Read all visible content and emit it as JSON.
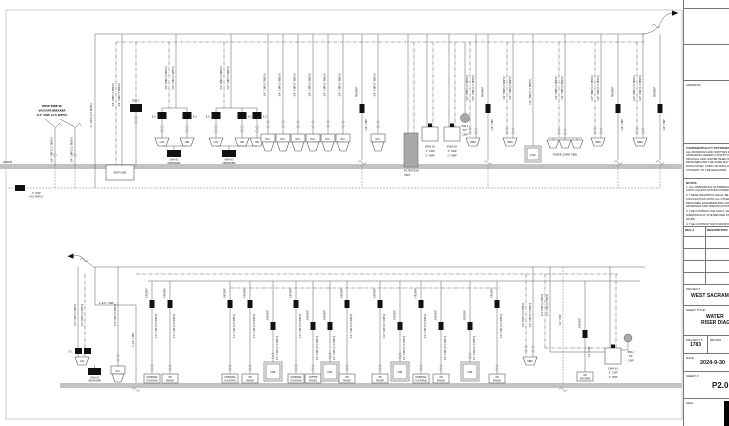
{
  "colors": {
    "line": "#5a5a5a",
    "grade": "#c2c2c2",
    "black": "#111111",
    "gray": "#a8a8a8",
    "paper": "#ffffff",
    "ink": "#151515"
  },
  "title_block": {
    "address_label": "ADDRESS:",
    "confidentiality_title": "CONFIDENTIALITY STATEMENT:",
    "confidentiality_lines": [
      "ALL DRAWINGS AND WRITTEN MATERIAL",
      "APPEARING HEREIN CONSTITUTE THE",
      "ORIGINAL AND UNPUBLISHED WORK OF THE",
      "DESIGNER AND THE SAME MAY NOT BE",
      "DUPLICATED, USED OR DISCLOSED WITHOUT",
      "CONSENT OF THE DESIGNER."
    ],
    "notes_title": "NOTES:",
    "notes_1": [
      "1. ALL DIMENSIONS IN IMPERIAL",
      "UNITS UNLESS STATED OTHERWISE."
    ],
    "notes_2": [
      "2. THESE DRAWINGS SHALL BE USED IN",
      "CONJUNCTION WITH ALL OTHER",
      "DESIGNER, ENGINEER AND CONTRACTOR",
      "DRAWINGS AND SPECIFICATIONS."
    ],
    "notes_3": [
      "3. THE CONTRACTOR SHALL VERIFY ALL",
      "DIMENSION AT SITE BEFORE STARTING",
      "WORK."
    ],
    "notes_4": [
      "4. THE CONTRACTOR IS RESPONSIBLE FOR",
      "PROVIDING ALL NECESSARY",
      "SUPPORT TO THE BUILDING AND",
      "ADJACENT STRUCTURES."
    ],
    "rev_num": "REV. #",
    "rev_desc": "DESCRIPTION",
    "project_label": "PROJECT:",
    "project_value": "WEST SACRAMENTO",
    "sheet_title_label": "SHEET TITLE:",
    "sheet_title_line1": "WATER",
    "sheet_title_line2": "RISER DIAGRAM",
    "project_num_label": "PROJECT #",
    "project_num_value": "1783",
    "drawn_label": "DRAWN",
    "drawn_value": "B",
    "date_label": "DATE",
    "date_value": "2024-9-30",
    "sheet_num_label": "SHEET #",
    "sheet_num_value": "P2.0",
    "seal_label": "SEAL"
  },
  "top": {
    "grade_label": "GRADE",
    "service_pipe_label": "1\" CWP (4.5 WSFU)",
    "meter_lines": [
      "1\" CWP",
      "(4.5 WSFU)"
    ],
    "hose_bibb_note": [
      "HOSE BIBB W/",
      "VACUUM BREAKER",
      "3/4\" CWP (2.5 WSFU)"
    ],
    "hose_bibb_pipe_label": "3/4\" CWP (2.5 WSFU)",
    "hose_bibb_xs": [
      55,
      75
    ],
    "mop_sink_label": "MOP SINK",
    "mop_risers": [
      {
        "x": 116,
        "k": "h",
        "label": "3/4\" HWP (1 WSFU)"
      },
      {
        "x": 122,
        "k": "s",
        "label": "3/4\" CWP (3 WSFU)"
      }
    ],
    "esh": {
      "x": 136,
      "label": "ESH-1"
    },
    "ev_label": "E.V.",
    "lav_groups": [
      {
        "risers": [
          {
            "x": 169,
            "k": "h",
            "label": "1/2\" HWP (2 WSFU)"
          },
          {
            "x": 176,
            "k": "s",
            "label": "1/2\" CWP (2 WSFU)"
          }
        ],
        "fixtures": [
          {
            "cx": 162,
            "label": "LAV"
          },
          {
            "cx": 187,
            "label": "URI"
          }
        ],
        "undersink": {
          "x": 167,
          "lines": [
            "UWH-01",
            "UNDERSINK"
          ]
        }
      },
      {
        "risers": [
          {
            "x": 224,
            "k": "h",
            "label": "3/4\" HWP (2 WSFU)"
          },
          {
            "x": 231,
            "k": "s",
            "label": "3/4\" CWP (3 WSFU)"
          }
        ],
        "fixtures": [
          {
            "cx": 216,
            "label": "LAV"
          },
          {
            "cx": 242,
            "label": "URI"
          },
          {
            "cx": 257,
            "label": "URI"
          }
        ],
        "undersink": {
          "x": 222,
          "lines": [
            "UWH-02",
            "UNDERSINK"
          ]
        }
      }
    ],
    "wc_label": "W.C.",
    "wc_pipe_label": "3/4\" CWP (5 WSFU)",
    "wc_xs": [
      268,
      283,
      298,
      313,
      328,
      343,
      378
    ],
    "rpz_label": "RPZ/BFP",
    "rpz_pipe_label": "1/2\" CWP",
    "rpz_xs": [
      362,
      488,
      618,
      660
    ],
    "filtration_lines": [
      "FILTRATION",
      "UNIT"
    ],
    "ewh_units": [
      {
        "cx": 430,
        "lines": [
          "EWH-01",
          "1\" CWP",
          "1\" HWP"
        ]
      },
      {
        "cx": 452,
        "lines": [
          "EWH-02",
          "1\" CWP",
          "1\" HWP"
        ]
      }
    ],
    "esp_lines": [
      "ESP-1",
      "3/4\"",
      "CWP"
    ],
    "sink_label": "SINK",
    "sinks": [
      {
        "cx": 473,
        "risers": [
          {
            "x": 470,
            "k": "h",
            "label": "3/4\" HWP (1.5 WSFU)"
          },
          {
            "x": 476,
            "k": "s",
            "label": "3/4\" CWP (1.5 WSFU)"
          }
        ]
      },
      {
        "cx": 510,
        "risers": [
          {
            "x": 507,
            "k": "h",
            "label": "3/4\" HWP (2 WSFU)"
          },
          {
            "x": 513,
            "k": "s",
            "label": "3/4\" CWP (2 WSFU)"
          }
        ]
      },
      {
        "cx": 598,
        "risers": [
          {
            "x": 595,
            "k": "h",
            "label": "1/2\" HWP (1.5 WSFU)"
          },
          {
            "x": 601,
            "k": "s",
            "label": "1/2\" CWP (1.5 WSFU)"
          }
        ]
      },
      {
        "cx": 640,
        "risers": [
          {
            "x": 637,
            "k": "h",
            "label": "1/2\" HWP (1.5 WSFU)"
          },
          {
            "x": 643,
            "k": "s",
            "label": "1/2\" CWP (1.5 WSFU)"
          }
        ]
      }
    ],
    "dw": {
      "cx": 533,
      "label": "DW",
      "pipe_label": "1/2\" CWP (1.5 WSFU)"
    },
    "three_comp": {
      "cxs": [
        553,
        565,
        577
      ],
      "label": "THREE COMP. SINK",
      "risers": [
        {
          "x": 559,
          "k": "h",
          "label": "3/4\" HWP (3 WSFU)"
        },
        {
          "x": 565,
          "k": "s",
          "label": "3/4\" CWP (3 WSFU)"
        }
      ]
    }
  },
  "bottom": {
    "service_label": "1-1/2\" CWP",
    "service_riser_label": "1-1/2\" CWP",
    "ev_label": "E.V.",
    "lav": {
      "label": "LAV"
    },
    "undersink_lines": [
      "UWH-03",
      "UNDERSINK"
    ],
    "wc": {
      "label": "W.C.",
      "pipe_label": "3/4\" CWP (5 WSFU)",
      "x": 118
    },
    "left_risers": [
      {
        "x": 78,
        "k": "s",
        "label": "1/2\" CWP (1 WSFU)"
      },
      {
        "x": 85,
        "k": "h",
        "label": "1/2\" HWP (1 WSFU)"
      }
    ],
    "rpz_label": "RPZ/BFP",
    "units": [
      {
        "x": 152,
        "t": "sm",
        "rpz_y": 300,
        "pipe": "1/2\" CWP (0.5 WSFU)",
        "lines": [
          "DRINKING",
          "FOUNTAIN"
        ]
      },
      {
        "x": 170,
        "t": "sm",
        "rpz_y": 300,
        "pipe": "1/2\" CWP (0.5 WSFU)",
        "lines": [
          "ICE",
          "MAKER"
        ]
      },
      {
        "x": 230,
        "t": "sm",
        "rpz_y": 300,
        "pipe": "1/2\" CWP (0.5 WSFU)",
        "lines": [
          "DRINKING",
          "FOUNTAIN"
        ]
      },
      {
        "x": 250,
        "t": "sm",
        "rpz_y": 300,
        "pipe": "1/2\" CWP (0.5 WSFU)",
        "lines": [
          "ICE",
          "MAKER"
        ]
      },
      {
        "x": 273,
        "t": "dw",
        "rpz_y": 322,
        "pipe": "1/2\" CWP (1.5 WSFU)",
        "label": "DW"
      },
      {
        "x": 296,
        "t": "sm",
        "rpz_y": 300,
        "pipe": "1/2\" CWP (0.5 WSFU)",
        "lines": [
          "DRINKING",
          "FOUNTAIN"
        ]
      },
      {
        "x": 313,
        "t": "sm",
        "rpz_y": 322,
        "pipe": "1/2\" CWP (0.5 WSFU)",
        "lines": [
          "COFFEE",
          "MAKER"
        ]
      },
      {
        "x": 330,
        "t": "dw",
        "rpz_y": 322,
        "pipe": "1/2\" CWP (1.5 WSFU)",
        "label": "DW"
      },
      {
        "x": 347,
        "t": "sm",
        "rpz_y": 300,
        "pipe": "1/2\" CWP (0.5 WSFU)",
        "lines": [
          "ICE",
          "MAKER"
        ]
      },
      {
        "x": 380,
        "t": "sm",
        "rpz_y": 300,
        "pipe": "1/2\" CWP (0.5 WSFU)",
        "lines": [
          "ICE",
          "MAKER"
        ]
      },
      {
        "x": 400,
        "t": "dw",
        "rpz_y": 322,
        "pipe": "1/2\" CWP (1.5 WSFU)",
        "label": "DW"
      },
      {
        "x": 421,
        "t": "sm",
        "rpz_y": 300,
        "pipe": "1/2\" CWP (0.5 WSFU)",
        "lines": [
          "DRINKING",
          "FOUNTAIN"
        ]
      },
      {
        "x": 441,
        "t": "sm",
        "rpz_y": 322,
        "pipe": "1/2\" CWP (0.5 WSFU)",
        "lines": [
          "ICE",
          "MAKER"
        ]
      },
      {
        "x": 470,
        "t": "dw",
        "rpz_y": 322,
        "pipe": "1/2\" CWP (1.5 WSFU)",
        "label": "DW"
      },
      {
        "x": 497,
        "t": "sm",
        "rpz_y": 300,
        "pipe": "1/2\" CWP (0.5 WSFU)",
        "lines": [
          "ICE",
          "MAKER"
        ]
      }
    ],
    "sink": {
      "cx": 530,
      "label": "SINK",
      "risers": [
        {
          "x": 526,
          "k": "h",
          "label": "1/2\" HWP (1.5 WSFU)"
        },
        {
          "x": 533,
          "k": "s",
          "label": "1/2\" CWP (1.5 WSFU)"
        }
      ]
    },
    "feed_risers": [
      {
        "x": 545,
        "k": "h",
        "label": "3/4\" HWP (2 WSFU)"
      },
      {
        "x": 550,
        "k": "s",
        "label": "3/4\" CWP (2 WSFU)"
      }
    ],
    "under_drop": {
      "x": 563,
      "label": "1/2\" CWP"
    },
    "ice_machine": {
      "x": 585,
      "rpz_y": 330,
      "pipe": "1/2\" CWP",
      "lines": [
        "ICE",
        "MACHINE"
      ]
    },
    "ewh3": {
      "cx": 613,
      "lines": [
        "EWH-03",
        "1\" CWP",
        "1\" HWP"
      ]
    },
    "esp_lines": [
      "ESP-1",
      "3/4\"",
      "CWP"
    ]
  }
}
